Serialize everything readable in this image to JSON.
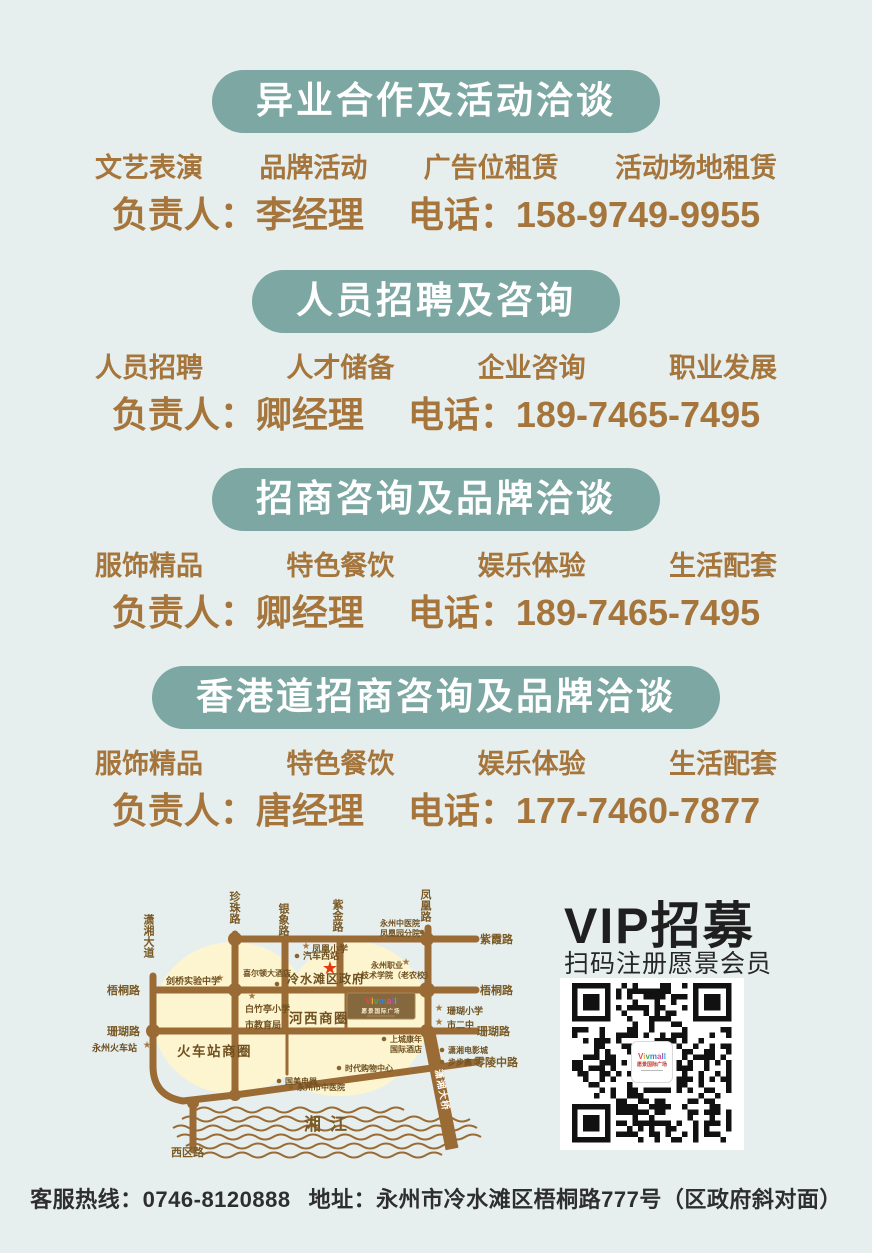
{
  "page": {
    "background": "#e6efee"
  },
  "sections": [
    {
      "title": "异业合作及活动洽谈",
      "categories": [
        "文艺表演",
        "品牌活动",
        "广告位租赁",
        "活动场地租赁"
      ],
      "contact_label": "负责人：",
      "contact_name": "李经理",
      "phone_label": "电话：",
      "phone": "158-9749-9955"
    },
    {
      "title": "人员招聘及咨询",
      "categories": [
        "人员招聘",
        "人才储备",
        "企业咨询",
        "职业发展"
      ],
      "contact_label": "负责人：",
      "contact_name": "卿经理",
      "phone_label": "电话：",
      "phone": "189-7465-7495"
    },
    {
      "title": "招商咨询及品牌洽谈",
      "categories": [
        "服饰精品",
        "特色餐饮",
        "娱乐体验",
        "生活配套"
      ],
      "contact_label": "负责人：",
      "contact_name": "卿经理",
      "phone_label": "电话：",
      "phone": "189-7465-7495"
    },
    {
      "title": "香港道招商咨询及品牌洽谈",
      "categories": [
        "服饰精品",
        "特色餐饮",
        "娱乐体验",
        "生活配套"
      ],
      "contact_label": "负责人：",
      "contact_name": "唐经理",
      "phone_label": "电话：",
      "phone": "177-7460-7877"
    }
  ],
  "vip": {
    "title": "VIP招募",
    "subtitle": "扫码注册愿景会员",
    "qr_logo": "Vivmall",
    "qr_logo_sub": "愿景国际广场"
  },
  "footer": {
    "hotline_label": "客服热线：",
    "hotline": "0746-8120888",
    "address_label": "地址：",
    "address": "永州市冷水滩区梧桐路777号（区政府斜对面）"
  },
  "colors": {
    "banner_teal": "#7ca7a2",
    "text_brown": "#a5753c",
    "map_road": "#9a6b35",
    "map_zone": "#fdf5d0",
    "red_star": "#e8380d",
    "logo_rainbow": [
      "#e8483f",
      "#f2a93b",
      "#3fae5a",
      "#3b7fd4",
      "#e84a8f",
      "#8f56c2",
      "#2ab5c9"
    ]
  },
  "map": {
    "mall": {
      "logo": "Vivmall",
      "name": "愿景国际广场"
    },
    "road_labels": [
      {
        "t": "潇湘大道",
        "x": 70,
        "y": 56,
        "v": 1
      },
      {
        "t": "珍珠路",
        "x": 156,
        "y": 33,
        "v": 1
      },
      {
        "t": "银象路",
        "x": 205,
        "y": 45,
        "v": 1
      },
      {
        "t": "紫金路",
        "x": 259,
        "y": 41,
        "v": 1
      },
      {
        "t": "凤凰路",
        "x": 347,
        "y": 31,
        "v": 1
      },
      {
        "t": "紫霞路",
        "x": 402,
        "y": 85
      },
      {
        "t": "梧桐路",
        "x": 29,
        "y": 136
      },
      {
        "t": "梧桐路",
        "x": 402,
        "y": 136
      },
      {
        "t": "珊瑚路",
        "x": 29,
        "y": 177
      },
      {
        "t": "珊瑚路",
        "x": 399,
        "y": 177
      },
      {
        "t": "零陵中路",
        "x": 396,
        "y": 208
      },
      {
        "t": "西区路",
        "x": 93,
        "y": 298
      }
    ],
    "landmarks": [
      {
        "m": "star",
        "sx": 228,
        "sy": 91,
        "t": "凤凰小学",
        "x": 234,
        "y": 94,
        "c": "msm"
      },
      {
        "m": "dot",
        "sx": 219,
        "sy": 98,
        "t": "汽车西站",
        "x": 225,
        "y": 101,
        "c": "msm"
      },
      {
        "m": "redstar",
        "sx": 252,
        "sy": 116
      },
      {
        "t": "冷水滩区政府",
        "x": 209,
        "y": 125,
        "c": "mbig2"
      },
      {
        "m": "dot",
        "sx": 344,
        "sy": 74,
        "t": "永州中医院",
        "x": 302,
        "y": 68,
        "c": "mxs"
      },
      {
        "t": "凤凰园分院",
        "x": 302,
        "y": 78,
        "c": "mxs"
      },
      {
        "m": "star",
        "sx": 328,
        "sy": 107,
        "t": "永州职业",
        "x": 293,
        "y": 110,
        "c": "mxs"
      },
      {
        "t": "技术学院（老农校）",
        "x": 283,
        "y": 120,
        "c": "mxs"
      },
      {
        "m": "star",
        "sx": 142,
        "sy": 123,
        "t": "剑桥实验中学",
        "x": 88,
        "y": 126,
        "c": "msm"
      },
      {
        "m": "dot",
        "sx": 199,
        "sy": 126,
        "t": "喜尔顿大酒店",
        "x": 165,
        "y": 118,
        "c": "mxs"
      },
      {
        "m": "star",
        "sx": 174,
        "sy": 141,
        "t": "白竹亭小学",
        "x": 167,
        "y": 154,
        "c": "msm"
      },
      {
        "t": "市教育局",
        "x": 167,
        "y": 170,
        "c": "msm"
      },
      {
        "t": "河西商圈",
        "x": 211,
        "y": 165,
        "c": "mbig"
      },
      {
        "m": "star",
        "sx": 361,
        "sy": 153,
        "t": "珊瑚小学",
        "x": 369,
        "y": 156,
        "c": "msm"
      },
      {
        "m": "star",
        "sx": 361,
        "sy": 167,
        "t": "市二中",
        "x": 369,
        "y": 170,
        "c": "msm"
      },
      {
        "m": "dot",
        "sx": 306,
        "sy": 181,
        "t": "上城康年",
        "x": 312,
        "y": 184,
        "c": "mxs"
      },
      {
        "t": "国际酒店",
        "x": 312,
        "y": 194,
        "c": "mxs"
      },
      {
        "m": "dot",
        "sx": 364,
        "sy": 192,
        "t": "潇湘电影城",
        "x": 370,
        "y": 195,
        "c": "mxs"
      },
      {
        "m": "dot",
        "sx": 364,
        "sy": 204,
        "t": "步步高",
        "x": 370,
        "y": 207,
        "c": "mxs"
      },
      {
        "m": "dot",
        "sx": 261,
        "sy": 210,
        "t": "时代购物中心",
        "x": 267,
        "y": 213,
        "c": "mxs"
      },
      {
        "m": "dot",
        "sx": 201,
        "sy": 223,
        "t": "国美电器",
        "x": 207,
        "y": 226,
        "c": "mxs"
      },
      {
        "m": "dot",
        "sx": 213,
        "sy": 229,
        "t": "永州市中医院",
        "x": 219,
        "y": 232,
        "c": "mxs"
      },
      {
        "m": "star",
        "sx": 69,
        "sy": 190,
        "t": "永州火车站",
        "x": 14,
        "y": 193,
        "c": "msm"
      },
      {
        "t": "火车站商圈",
        "x": 99,
        "y": 198,
        "c": "mbig"
      },
      {
        "t": "湘江",
        "x": 226,
        "y": 272,
        "c": "mriver"
      },
      {
        "t": "潇湘大桥",
        "x": 357,
        "y": 212,
        "c": "mbridge",
        "rot": 79
      }
    ]
  }
}
